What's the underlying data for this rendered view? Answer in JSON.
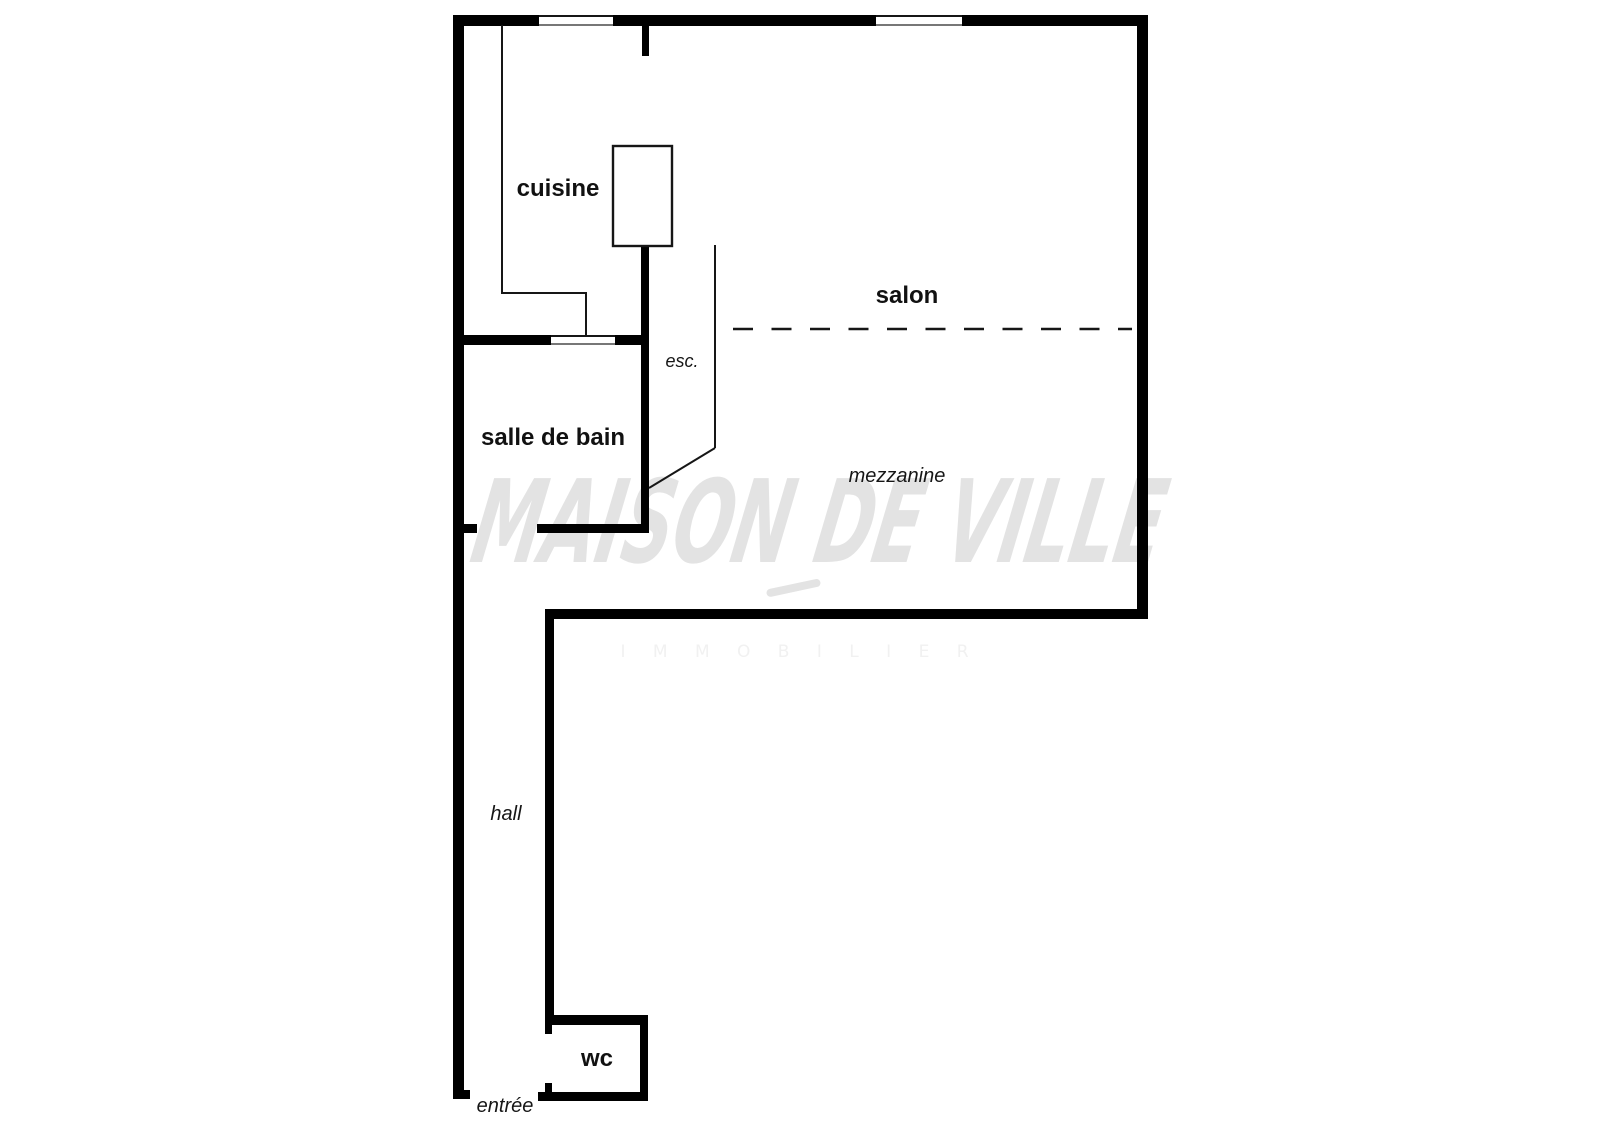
{
  "meta": {
    "title": "Floor plan — maison de ville",
    "background": "#ffffff"
  },
  "watermark": {
    "line1": "MAISON DE VILLE",
    "line2": "I M M O B I L I E R",
    "color_main": "#e3e3e3",
    "color_sub": "#f1f1f1"
  },
  "labels": {
    "cuisine": {
      "text": "cuisine",
      "x": 558,
      "y": 196
    },
    "salon": {
      "text": "salon",
      "x": 907,
      "y": 303
    },
    "salle_de_bain": {
      "text": "salle de bain",
      "x": 553,
      "y": 445
    },
    "wc": {
      "text": "wc",
      "x": 597,
      "y": 1066
    },
    "esc": {
      "text": "esc.",
      "x": 682,
      "y": 367
    },
    "mezzanine": {
      "text": "mezzanine",
      "x": 897,
      "y": 482
    },
    "hall": {
      "text": "hall",
      "x": 506,
      "y": 820
    },
    "entree": {
      "text": "entrée",
      "x": 505,
      "y": 1112
    }
  },
  "plan": {
    "colors": {
      "wall": "#000000",
      "thin_line": "#161616",
      "fixture_fill": "#ffffff",
      "opening_fill": "#ffffff"
    },
    "walls": [
      {
        "name": "top-exterior-wall",
        "x": 453,
        "y": 15,
        "w": 695,
        "h": 11
      },
      {
        "name": "left-exterior-wall",
        "x": 453,
        "y": 15,
        "w": 11,
        "h": 1084
      },
      {
        "name": "left-wall-bottom-foot",
        "x": 453,
        "y": 1090,
        "w": 17,
        "h": 9
      },
      {
        "name": "right-exterior-wall",
        "x": 1137,
        "y": 15,
        "w": 11,
        "h": 604
      },
      {
        "name": "mezzanine-bottom-wall",
        "x": 545,
        "y": 609,
        "w": 603,
        "h": 10
      },
      {
        "name": "hall-right-wall",
        "x": 545,
        "y": 609,
        "w": 9,
        "h": 416
      },
      {
        "name": "wc-top-wall",
        "x": 545,
        "y": 1015,
        "w": 103,
        "h": 10
      },
      {
        "name": "wc-right-wall",
        "x": 640,
        "y": 1015,
        "w": 8,
        "h": 86
      },
      {
        "name": "wc-bottom-wall",
        "x": 538,
        "y": 1092,
        "w": 110,
        "h": 9
      },
      {
        "name": "wc-door-jamb-top",
        "x": 545,
        "y": 1025,
        "w": 7,
        "h": 9
      },
      {
        "name": "wc-door-jamb-bottom",
        "x": 545,
        "y": 1083,
        "w": 7,
        "h": 9
      },
      {
        "name": "kitchen-entry-wall-stub",
        "x": 642,
        "y": 25,
        "w": 7,
        "h": 31
      },
      {
        "name": "kitchen-bathroom-right-wall",
        "x": 641,
        "y": 246,
        "w": 8,
        "h": 287
      },
      {
        "name": "bathroom-top-wall-left",
        "x": 464,
        "y": 335,
        "w": 87,
        "h": 10
      },
      {
        "name": "bathroom-top-wall-right",
        "x": 615,
        "y": 335,
        "w": 34,
        "h": 10
      },
      {
        "name": "bathroom-bottom-wall-stub",
        "x": 464,
        "y": 524,
        "w": 13,
        "h": 9
      },
      {
        "name": "bathroom-bottom-wall-main",
        "x": 537,
        "y": 524,
        "w": 112,
        "h": 9
      }
    ],
    "openings": [
      {
        "name": "window-top-left",
        "x": 539,
        "y": 15,
        "w": 74,
        "h": 11
      },
      {
        "name": "window-top-right",
        "x": 876,
        "y": 15,
        "w": 86,
        "h": 11
      },
      {
        "name": "bathroom-door-opening",
        "x": 551,
        "y": 335,
        "w": 64,
        "h": 10
      }
    ],
    "thin_lines": [
      {
        "name": "kitchen-counter-left",
        "x1": 502,
        "y1": 25,
        "x2": 502,
        "y2": 294
      },
      {
        "name": "kitchen-counter-bottom",
        "x1": 501,
        "y1": 293,
        "x2": 587,
        "y2": 293
      },
      {
        "name": "kitchen-counter-drop",
        "x1": 586,
        "y1": 292,
        "x2": 586,
        "y2": 335
      },
      {
        "name": "stair-edge-vertical",
        "x1": 715,
        "y1": 245,
        "x2": 715,
        "y2": 448
      },
      {
        "name": "stair-edge-diagonal",
        "x1": 715,
        "y1": 448,
        "x2": 649,
        "y2": 488
      },
      {
        "name": "mezzanine-dashed-edge",
        "x1": 733,
        "y1": 329,
        "x2": 1132,
        "y2": 329,
        "dash": [
          20,
          18.5
        ],
        "width": 2.6
      }
    ],
    "fixtures": [
      {
        "name": "kitchen-column-fixture",
        "x": 613,
        "y": 146,
        "w": 59,
        "h": 100
      }
    ]
  }
}
